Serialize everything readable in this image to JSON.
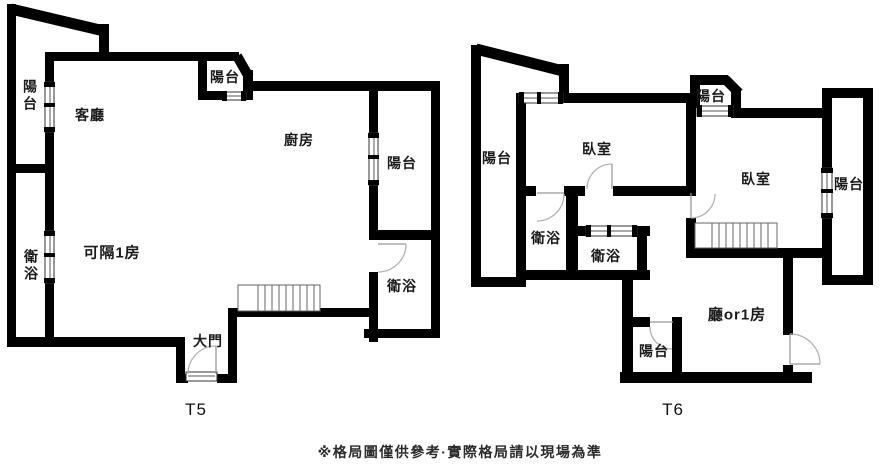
{
  "plans": [
    {
      "id": "t5",
      "title": "T5",
      "rooms": {
        "balcony_left": "陽台",
        "living_room": "客廳",
        "balcony_top": "陽台",
        "kitchen": "廚房",
        "balcony_right": "陽台",
        "bathroom_left": "衛浴",
        "flex_room": "可隔1房",
        "bathroom_right": "衛浴",
        "main_door": "大門"
      }
    },
    {
      "id": "t6",
      "title": "T6",
      "rooms": {
        "balcony_left": "陽台",
        "bedroom_left": "臥室",
        "balcony_top": "陽台",
        "bedroom_right": "臥室",
        "balcony_right": "陽台",
        "bathroom_1": "衛浴",
        "bathroom_2": "衛浴",
        "hall_or_room": "廳or1房",
        "balcony_bottom": "陽台"
      }
    }
  ],
  "footer": {
    "disclaimer": "※格局圖僅供參考·實際格局請以現場為準"
  },
  "colors": {
    "wall": "#000000",
    "background": "#ffffff",
    "door_arc": "#b3b3b3",
    "stairs": "#666666",
    "text": "#1a1a1a"
  }
}
